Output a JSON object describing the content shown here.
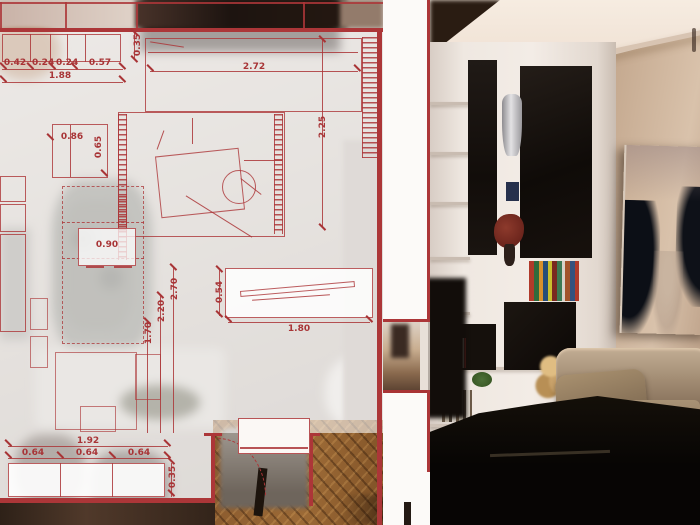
{
  "title": "Interior design presentation — floor plan overlay with living room render",
  "plan": {
    "dims": {
      "wardrobe_chain": [
        "0.42",
        "0.24",
        "0.24",
        "0.57"
      ],
      "wardrobe_total": "1.88",
      "wardrobe_depth": "0.35",
      "sofa_width": "2.72",
      "room_height": "2.25",
      "armchair_width": "0.86",
      "armchair_depth": "0.65",
      "cabinet_width": "0.90",
      "room_chain": [
        "2.70",
        "2.20",
        "1.70"
      ],
      "tv_depth": "0.54",
      "tv_width": "1.80",
      "sideboard_total": "1.92",
      "sideboard_chain": [
        "0.64",
        "0.64",
        "0.64"
      ],
      "sideboard_depth": "0.35"
    }
  },
  "colors": {
    "plan_red": "#ac3638",
    "plan_border_red": "#a93335",
    "overlay_white": "rgba(255,255,255,0.6)",
    "wall_beige": "#c3a78d",
    "shelf_white": "#ece4dd",
    "panel_black": "#17120f",
    "painting_dark": "#252e3a",
    "sofa_taupe": "#a8957f",
    "parquet_brown": "#8a5a2e"
  }
}
